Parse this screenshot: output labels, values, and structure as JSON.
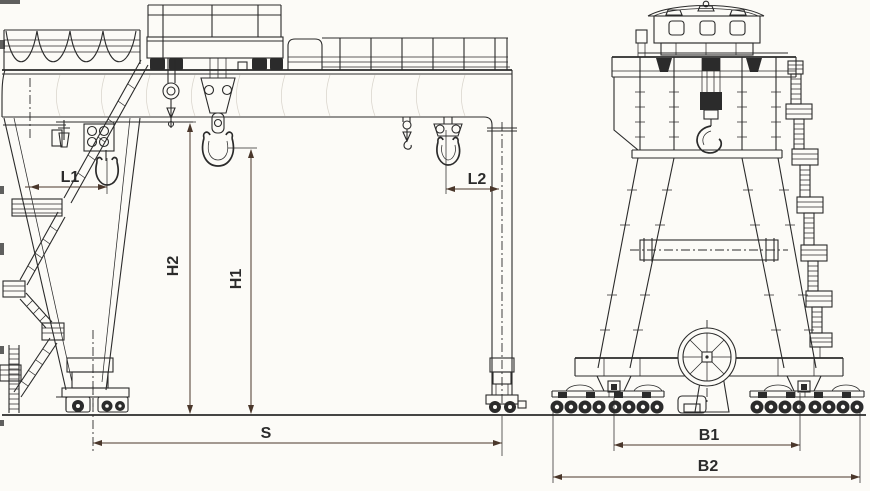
{
  "dimensions": {
    "l1": "L1",
    "l2": "L2",
    "h1": "H1",
    "h2": "H2",
    "span": "S",
    "b1": "B1",
    "b2": "B2"
  },
  "colors": {
    "ink": "#2b2b2b",
    "dim": "#4a372b",
    "paper": "#fcfbf7"
  }
}
